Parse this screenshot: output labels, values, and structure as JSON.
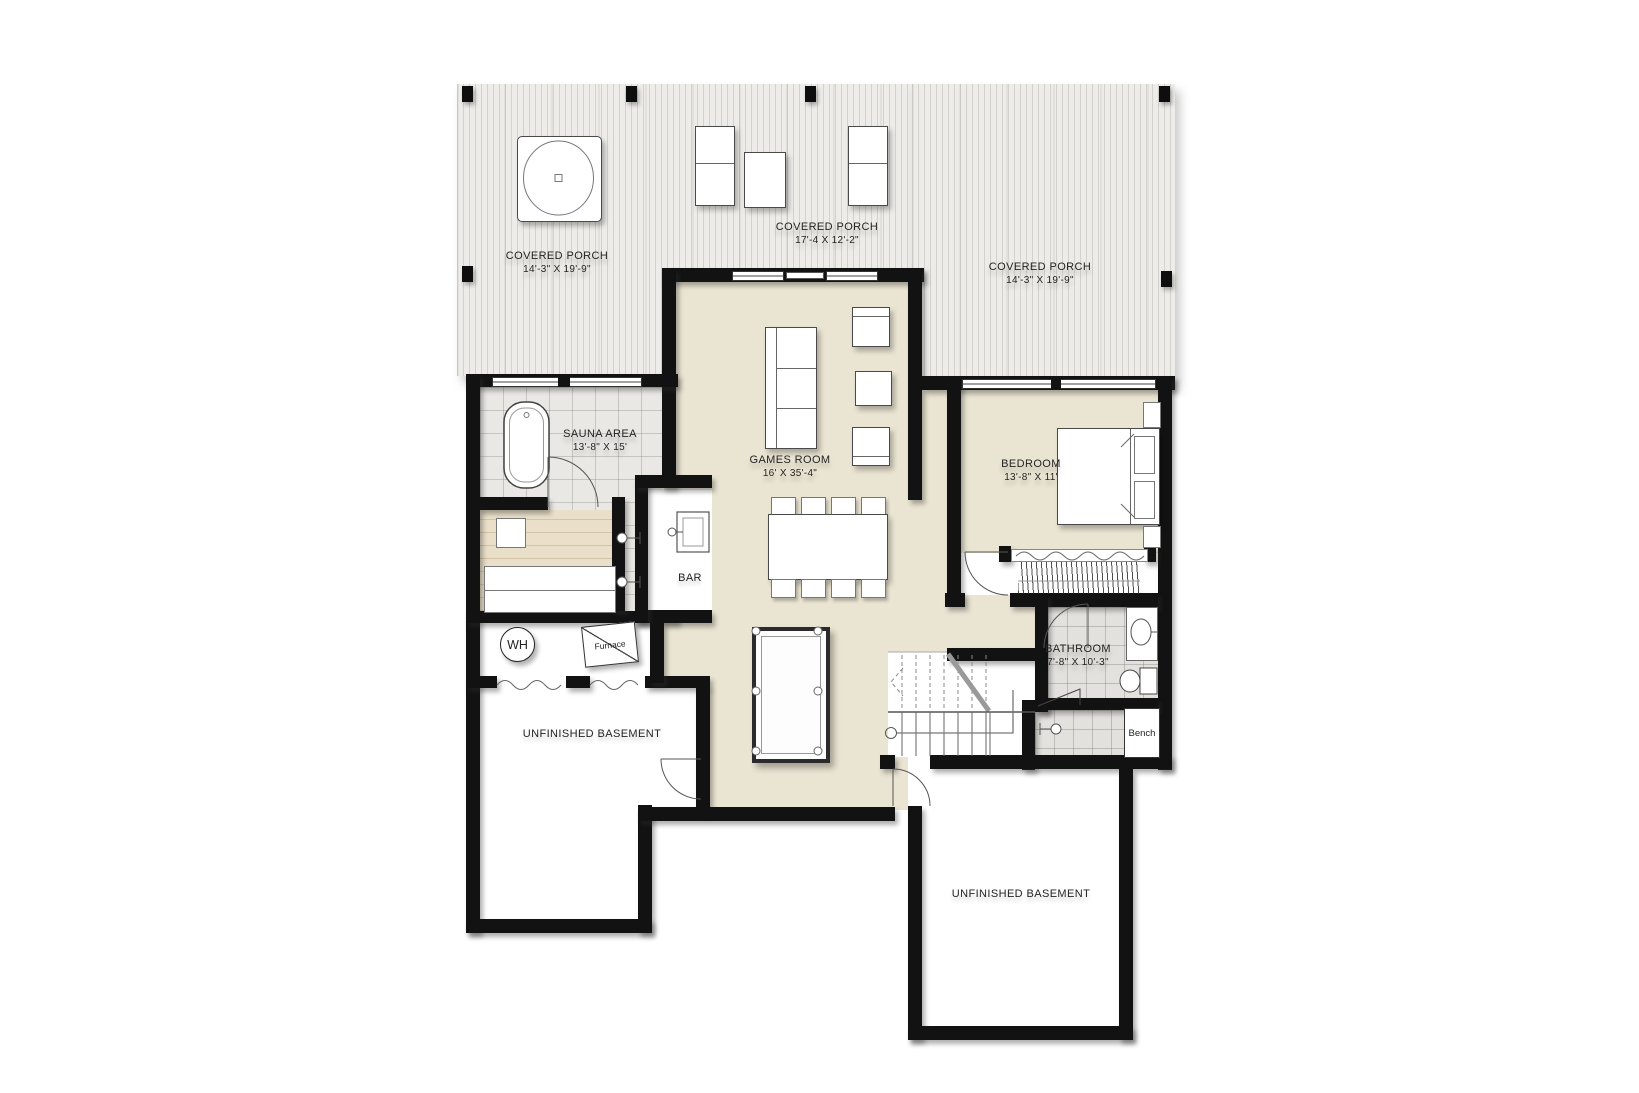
{
  "rooms": {
    "porch_left": {
      "name": "COVERED PORCH",
      "dims": "14'-3\" X 19'-9\""
    },
    "porch_center": {
      "name": "COVERED PORCH",
      "dims": "17'-4 X 12'-2\""
    },
    "porch_right": {
      "name": "COVERED PORCH",
      "dims": "14'-3\" X 19'-9\""
    },
    "sauna": {
      "name": "SAUNA AREA",
      "dims": "13'-8\" X 15'"
    },
    "games": {
      "name": "GAMES ROOM",
      "dims": "16' X 35'-4\""
    },
    "bedroom": {
      "name": "BEDROOM",
      "dims": "13'-8\" X 11'"
    },
    "bathroom": {
      "name": "BATHROOM",
      "dims": "7'-8\" X 10'-3\""
    },
    "bar": {
      "name": "BAR"
    },
    "basement_left": {
      "name": "UNFINISHED BASEMENT"
    },
    "basement_right": {
      "name": "UNFINISHED BASEMENT"
    }
  },
  "equipment": {
    "water_heater": "WH",
    "furnace": "Furnace",
    "bench": "Bench"
  },
  "colors": {
    "wall": "#121212",
    "floor_beige": "#eae4d2",
    "tile": "#e9e8e5",
    "bath_tile": "#e2e1dd",
    "wood": "#eadfc8",
    "deck": "#edece8",
    "background": "#ffffff"
  }
}
